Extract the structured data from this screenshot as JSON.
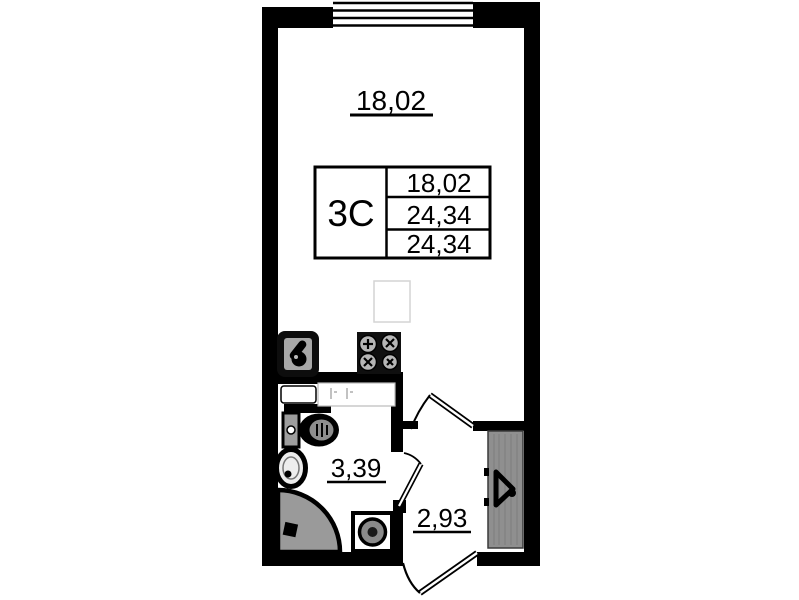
{
  "floor_plan": {
    "main_room_area": "18,02",
    "bathroom_area": "3,39",
    "hallway_area": "2,93",
    "spec_table": {
      "unit_type": "3С",
      "rows": [
        "18,02",
        "24,34",
        "24,34"
      ]
    },
    "colors": {
      "wall": "#000000",
      "background": "#ffffff",
      "shower_gray": "#9a9a9a",
      "wardrobe_gray": "#8f8f8f",
      "fixture_gray": "#a8a8a8"
    },
    "icons": {
      "window": "window-symbol",
      "kitchen_sink": "kitchen-sink-icon",
      "stove": "stove-burners-icon",
      "fridge": "fridge-outline-icon",
      "toilet": "toilet-icon",
      "washbasin": "washbasin-icon",
      "shower": "shower-tray-icon",
      "washing_machine": "washing-machine-icon",
      "wardrobe": "wardrobe-hanger-icon",
      "doors": "door-swing-arc"
    }
  }
}
